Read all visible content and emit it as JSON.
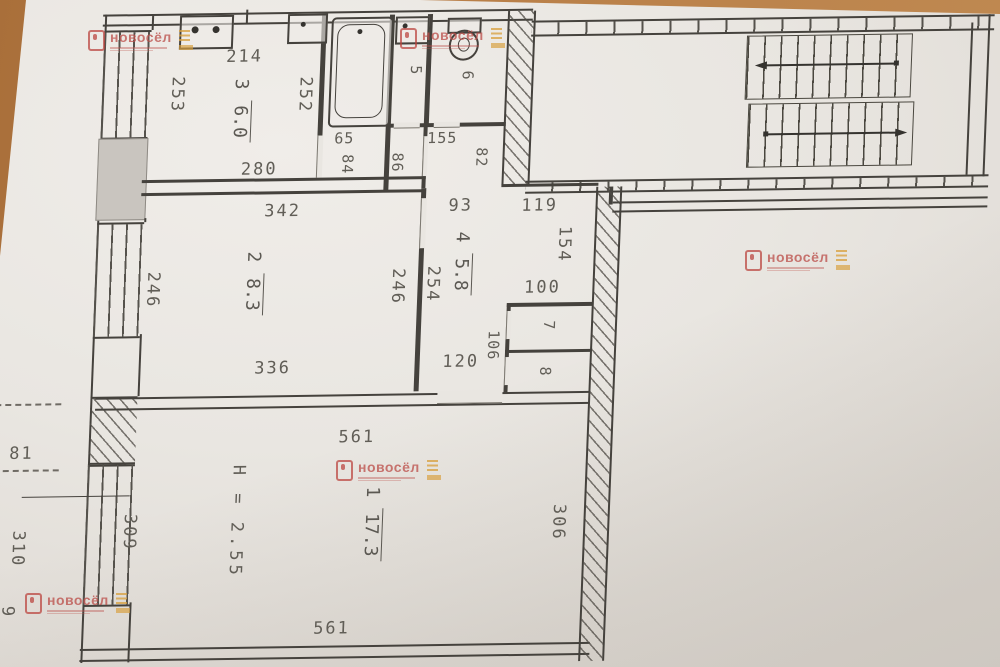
{
  "rooms": [
    {
      "id": "room-1",
      "number": "1",
      "area": "17.3"
    },
    {
      "id": "room-2",
      "number": "2",
      "area": "8.3"
    },
    {
      "id": "room-3-kitchen",
      "number": "3",
      "area": "6.0"
    },
    {
      "id": "room-4-hall",
      "number": "4",
      "area": "5.8"
    },
    {
      "id": "room-5-bath",
      "number": "5"
    },
    {
      "id": "room-6-wc",
      "number": "6"
    },
    {
      "id": "closet-7",
      "number": "7"
    },
    {
      "id": "closet-8",
      "number": "8"
    }
  ],
  "dimensions": {
    "kitchen_top": "214",
    "kitchen_left": "253",
    "kitchen_right": "252",
    "kitchen_bottom": "280",
    "hall_65": "65",
    "hall_84": "84",
    "hall_86": "86",
    "hall_155": "155",
    "hall_82": "82",
    "corridor_93": "93",
    "corridor_119": "119",
    "corridor_154": "154",
    "corridor_254": "254",
    "corridor_100": "100",
    "corridor_106": "106",
    "corridor_120": "120",
    "room2_top": "342",
    "room2_left": "246",
    "room2_right": "246",
    "room2_bottom": "336",
    "room1_top": "561",
    "room1_bottom": "561",
    "room1_right": "306",
    "room1_left": "309",
    "balcony_81": "81",
    "balcony_310": "310",
    "balcony_9": "9"
  },
  "notes": {
    "ceiling_height": "H = 2.55"
  },
  "watermark": {
    "name": "новосёл"
  },
  "icons": [
    "stove-icon",
    "kitchen-sink-icon",
    "washbasin-icon",
    "toilet-icon",
    "bathtub-icon",
    "stair-arrow-left-icon",
    "stair-arrow-right-icon"
  ],
  "colors": {
    "photo_background": "#b97f48",
    "paper": "#e9e6e1",
    "line": "#45423d",
    "watermark_red": "#bc504b",
    "watermark_yellow": "#d8a03e"
  }
}
